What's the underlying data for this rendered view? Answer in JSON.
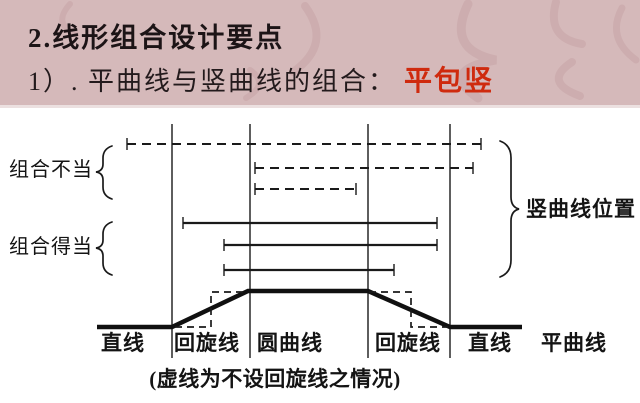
{
  "slide": {
    "title": "2.线形组合设计要点",
    "subtitle": "1）. 平曲线与竖曲线的组合：",
    "subtitle_highlight": "平包竖",
    "colors": {
      "header_bg": "#d5b9ba",
      "highlight_red": "#cf2a0e",
      "text": "#1c1416",
      "line": "#1a1a1a"
    }
  },
  "diagram": {
    "label_improper": "组合不当",
    "label_proper": "组合得当",
    "label_vertical_curve_position": "竖曲线位置",
    "caption": "(虚线为不设回旋线之情况)",
    "bottom_labels": [
      "直线",
      "回旋线",
      "圆曲线",
      "回旋线",
      "直线"
    ],
    "axis_label": "平曲线",
    "geometry": {
      "verticals": {
        "x": [
          172,
          250,
          368,
          450
        ],
        "y1": 124,
        "y2": 358
      },
      "bars": [
        {
          "y": 144,
          "x1": 127,
          "x2": 481,
          "dashed": true
        },
        {
          "y": 168,
          "x1": 255,
          "x2": 473,
          "dashed": true
        },
        {
          "y": 189,
          "x1": 255,
          "x2": 356,
          "dashed": true
        },
        {
          "y": 223,
          "x1": 183,
          "x2": 437,
          "dashed": false
        },
        {
          "y": 245,
          "x1": 224,
          "x2": 437,
          "dashed": false
        },
        {
          "y": 270,
          "x1": 224,
          "x2": 394,
          "dashed": false
        }
      ],
      "tick_half": 6,
      "profile": [
        [
          97,
          327
        ],
        [
          172,
          327
        ],
        [
          248,
          291
        ],
        [
          368,
          291
        ],
        [
          450,
          327
        ],
        [
          522,
          327
        ]
      ],
      "dashed_steps": [
        [
          [
            175,
            327
          ],
          [
            211,
            327
          ],
          [
            211,
            292
          ],
          [
            247,
            292
          ]
        ],
        [
          [
            369,
            292
          ],
          [
            411,
            292
          ],
          [
            411,
            327
          ],
          [
            448,
            327
          ]
        ]
      ],
      "braces": [
        {
          "name": "improper-brace",
          "d": "M112,146 Q103,149 103,158 L103,164 Q103,171 96,172 Q103,173 103,180 L103,187 Q103,196 112,199"
        },
        {
          "name": "proper-brace",
          "d": "M112,222 Q103,225 103,234 L103,240 Q103,247 96,248 Q103,249 103,256 L103,263 Q103,272 112,275"
        },
        {
          "name": "vertical-curve-brace",
          "d": "M500,141 Q511,145 511,158 L511,197 Q511,207 519,209 Q511,211 511,221 L511,260 Q511,273 500,277"
        }
      ]
    }
  }
}
